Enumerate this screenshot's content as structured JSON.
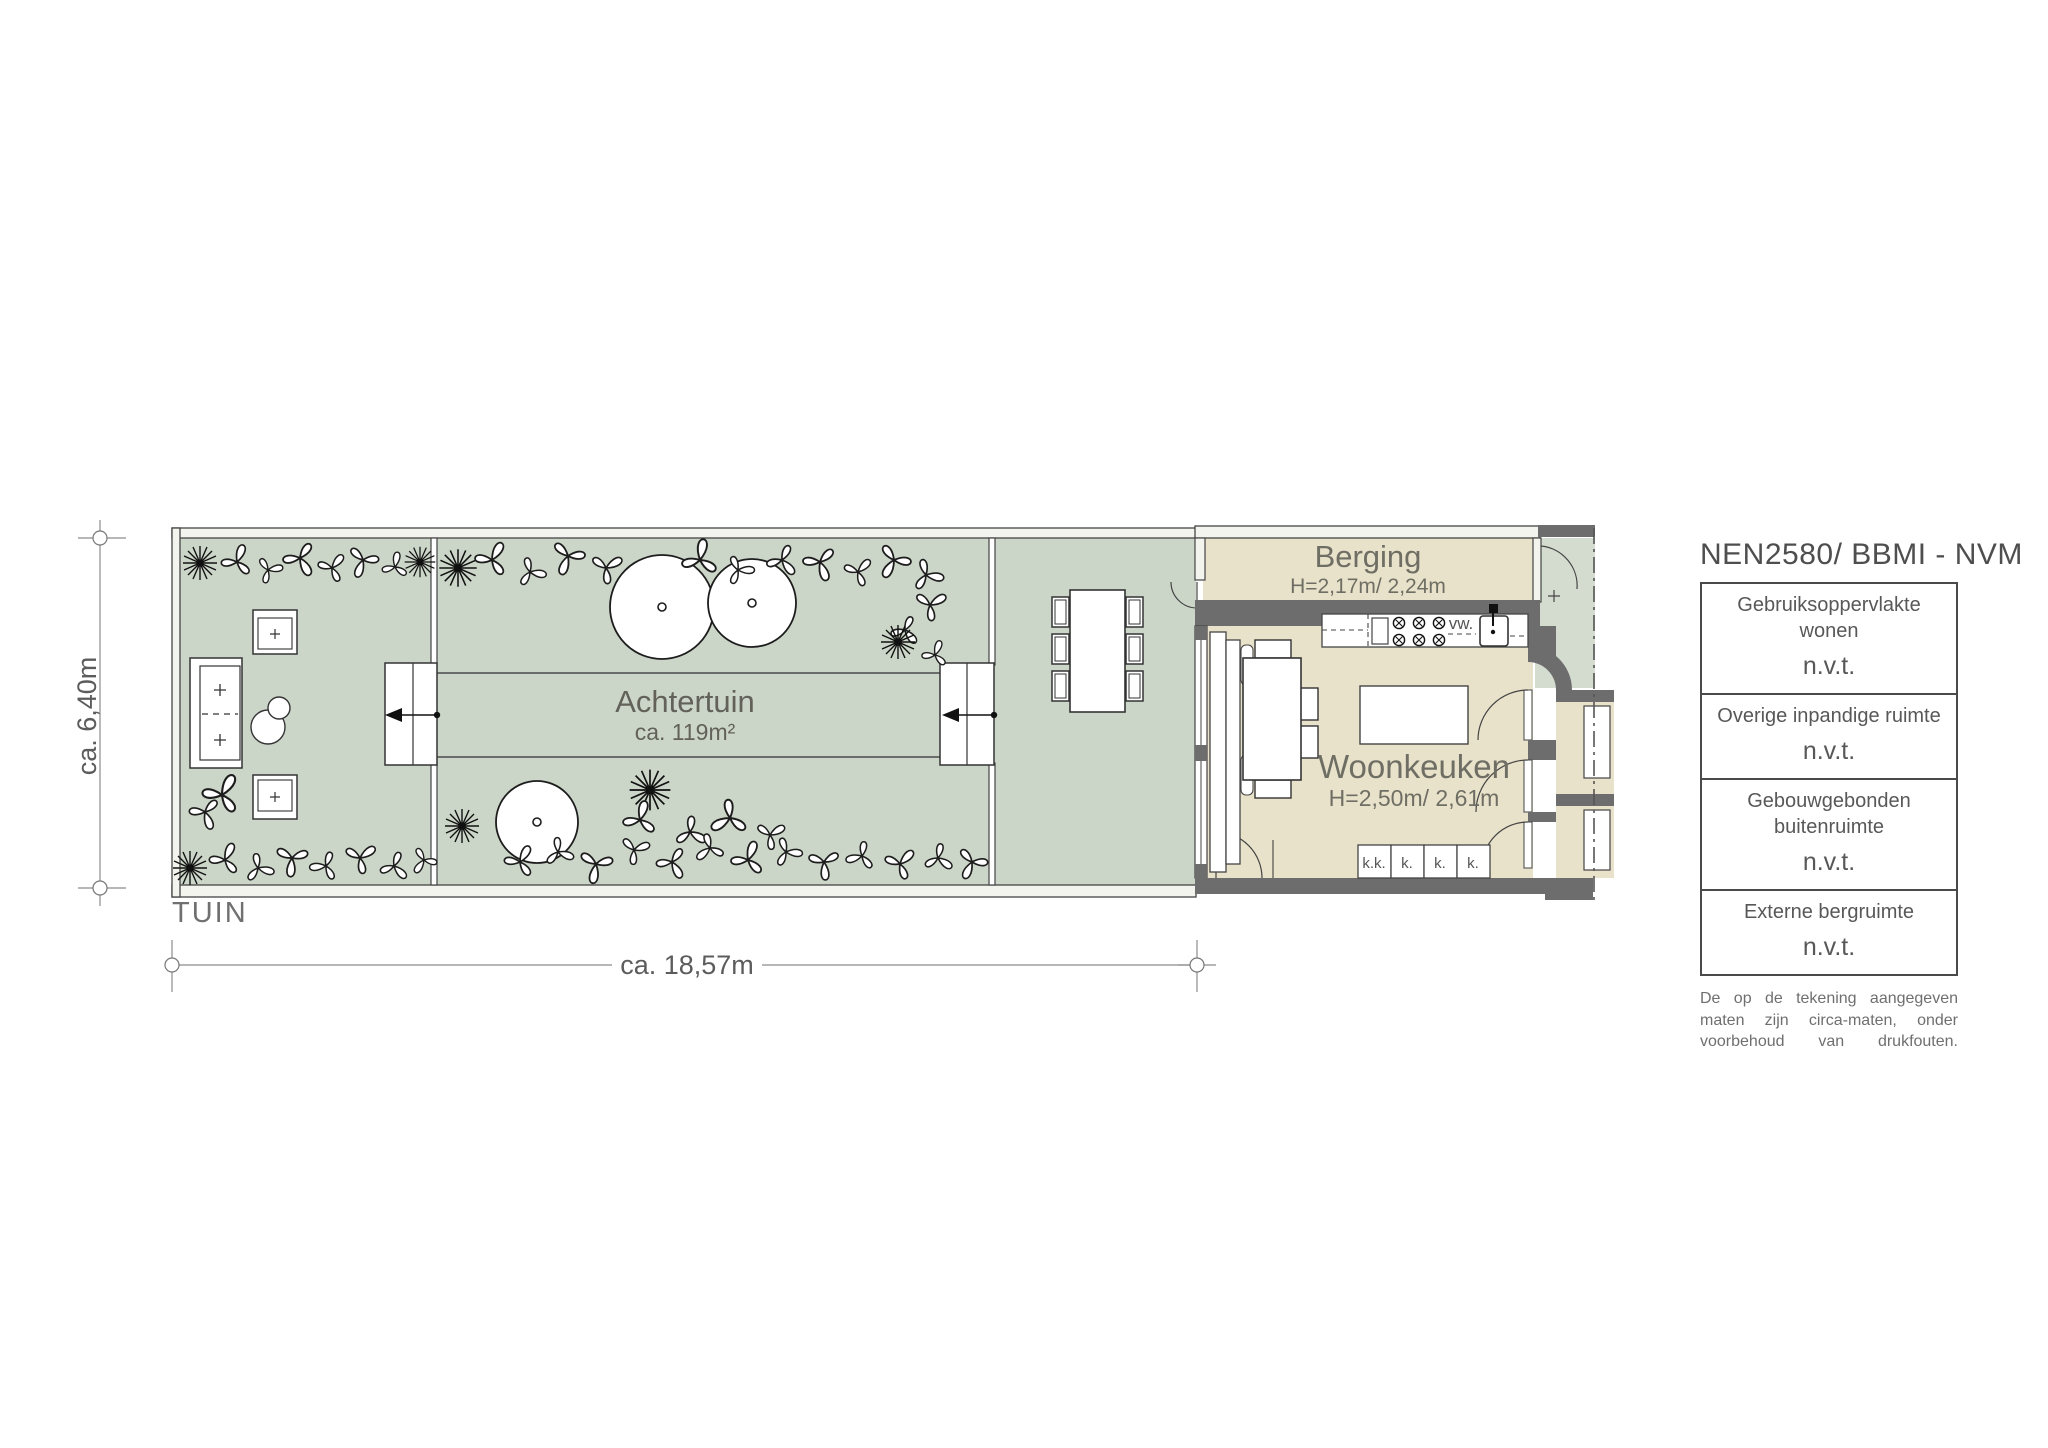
{
  "plan": {
    "site_label": "TUIN",
    "garden": {
      "name": "Achtertuin",
      "area": "ca. 119m²"
    },
    "storage": {
      "name": "Berging",
      "heights": "H=2,17m/ 2,24m"
    },
    "kitchen": {
      "name": "Woonkeuken",
      "heights": "H=2,50m/ 2,61m",
      "appliance_label": "vw.",
      "units": [
        "k.k.",
        "k.",
        "k.",
        "k."
      ]
    },
    "dimensions": {
      "horizontal": "ca. 18,57m",
      "vertical": "ca. 6,40m"
    }
  },
  "legend": {
    "title": "NEN2580/ BBMI - NVM",
    "rows": [
      {
        "label": "Gebruiksoppervlakte wonen",
        "value": "n.v.t."
      },
      {
        "label": "Overige inpandige ruimte",
        "value": "n.v.t."
      },
      {
        "label": "Gebouwgebonden buitenruimte",
        "value": "n.v.t."
      },
      {
        "label": "Externe bergruimte",
        "value": "n.v.t."
      }
    ],
    "disclaimer": "De op de tekening aangegeven maten zijn circa-maten, onder voorbehoud van drukfouten."
  },
  "colors": {
    "garden": "#ccd6c8",
    "floor": "#e9e2ca",
    "wall": "#6d6d6d",
    "line": "#3f3f3f"
  }
}
